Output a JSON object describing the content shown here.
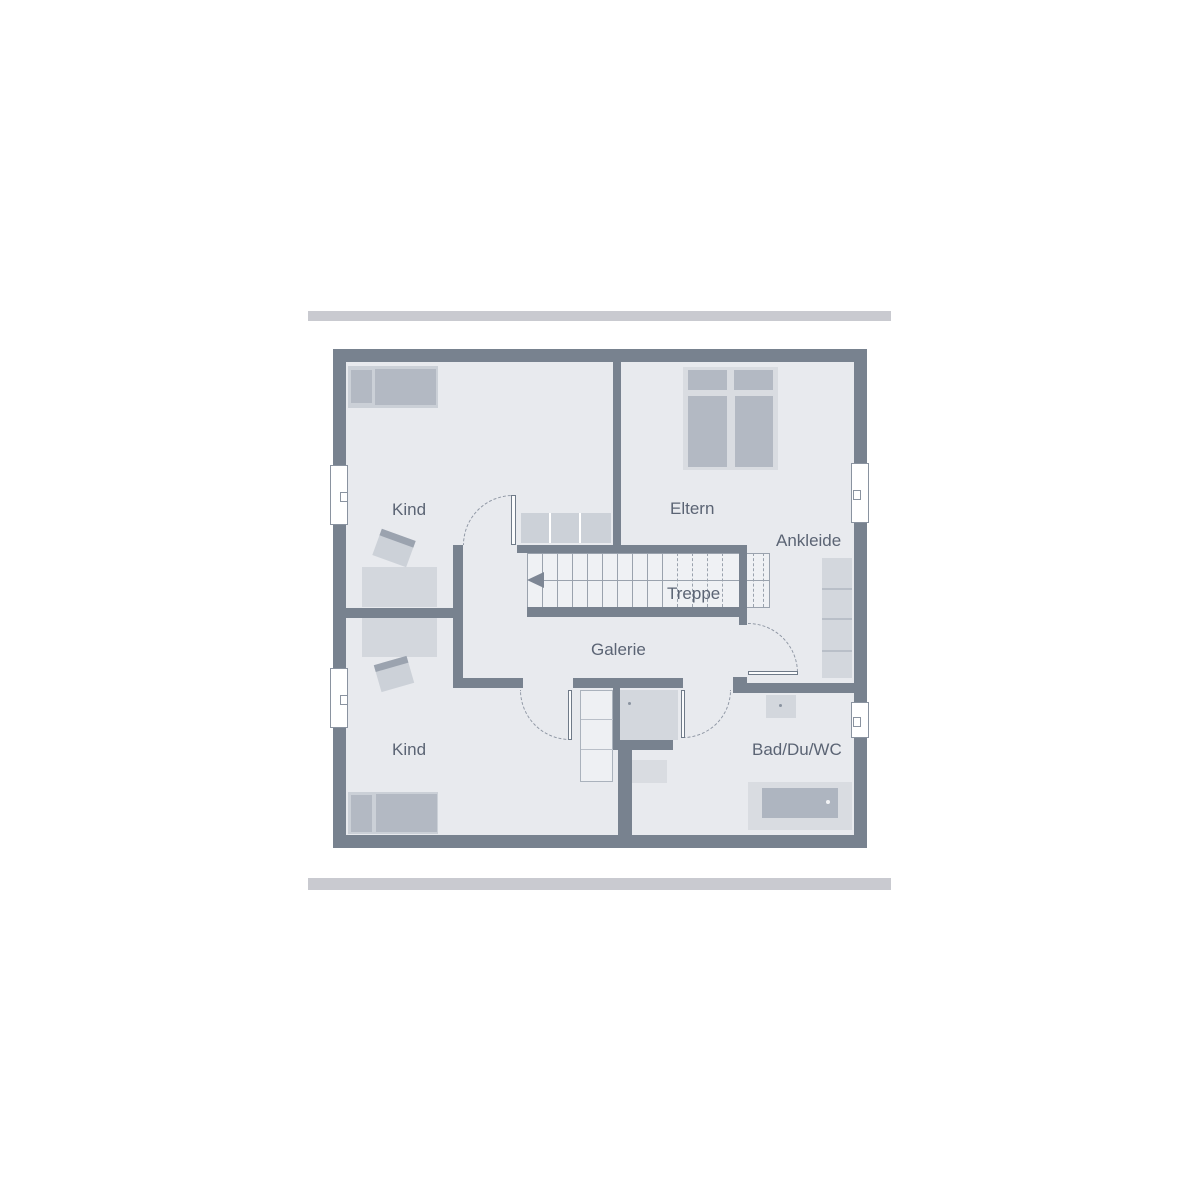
{
  "plan": {
    "room_labels": [
      {
        "id": "kind-top",
        "label": "Kind"
      },
      {
        "id": "eltern",
        "label": "Eltern"
      },
      {
        "id": "ankleide",
        "label": "Ankleide"
      },
      {
        "id": "treppe",
        "label": "Treppe"
      },
      {
        "id": "galerie",
        "label": "Galerie"
      },
      {
        "id": "kind-bottom",
        "label": "Kind"
      },
      {
        "id": "bad-du-wc",
        "label": "Bad/Du/WC"
      }
    ],
    "stairs": {
      "label": "Treppe",
      "direction": "left",
      "solid_treads": 9,
      "dashed_treads": 6
    },
    "icons": [
      {
        "name": "stairs-direction-arrow",
        "meaning": "direction of stair run, pointing left"
      }
    ],
    "colors": {
      "wall": "#78828f",
      "room_fill": "#e8eaee",
      "stair_fill": "#eff1f4",
      "furniture": "#b3b9c3",
      "furniture_light": "#d3d7dd",
      "outline": "#9aa2ad",
      "label_text": "#5b6474",
      "frame_bar": "#c9cad0",
      "window": "#ffffff"
    }
  }
}
